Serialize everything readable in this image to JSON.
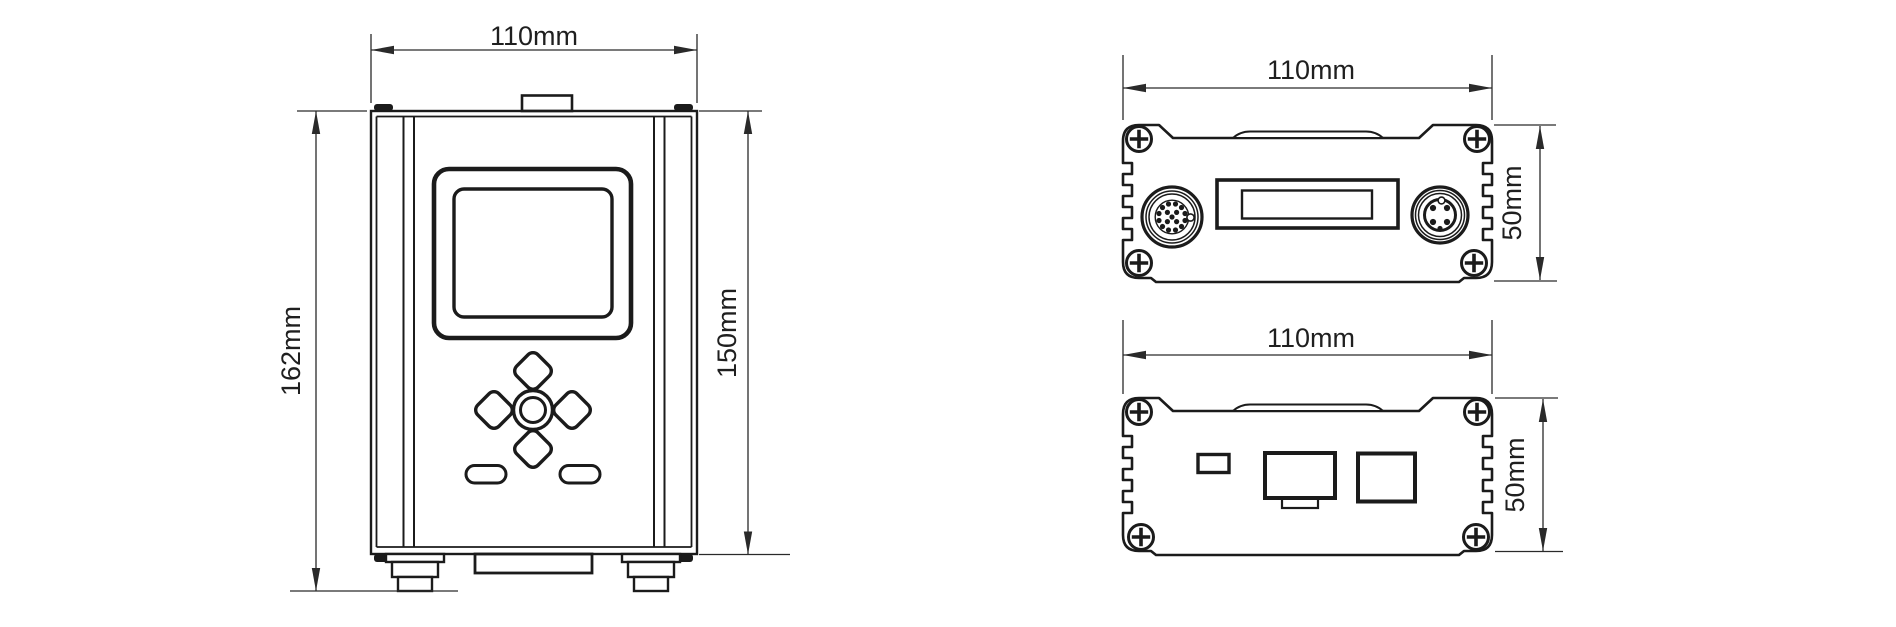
{
  "drawing": {
    "background": "#ffffff",
    "ink": "#1b1b1b",
    "views": {
      "front": {
        "width_label": "110mm",
        "height_left_label": "162mm",
        "height_right_label": "150mm"
      },
      "rear_top": {
        "width_label": "110mm",
        "height_label": "50mm"
      },
      "rear_bottom": {
        "width_label": "110mm",
        "height_label": "50mm"
      }
    }
  }
}
